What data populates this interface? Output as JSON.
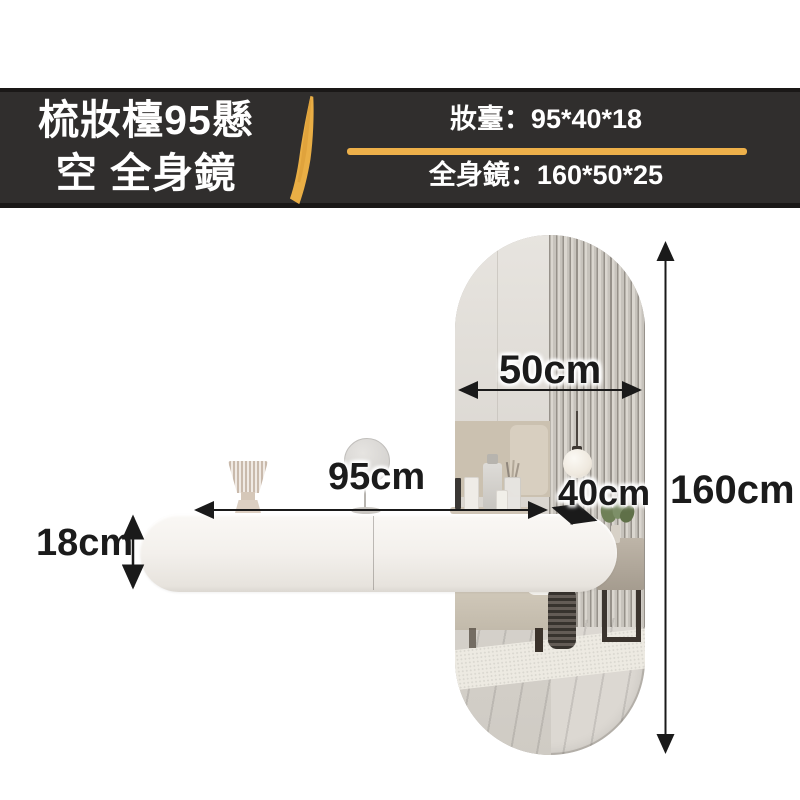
{
  "banner": {
    "title_line1": "梳妝檯95懸",
    "title_line2": "空 全身鏡",
    "spec_top": "妝臺：95*40*18",
    "spec_bottom": "全身鏡：160*50*25"
  },
  "colors": {
    "banner_bg": "#302e2d",
    "banner_border": "#1a1817",
    "accent_gold": "#edb04a",
    "banner_text": "#ffffff",
    "dimension_text": "#1b1b1b",
    "table_white": "#f3f0ec",
    "floor_wood": "#9b7458"
  },
  "dimensions": {
    "mirror_width": "50cm",
    "mirror_height": "160cm",
    "table_width": "95cm",
    "table_depth": "40cm",
    "table_height": "18cm"
  }
}
